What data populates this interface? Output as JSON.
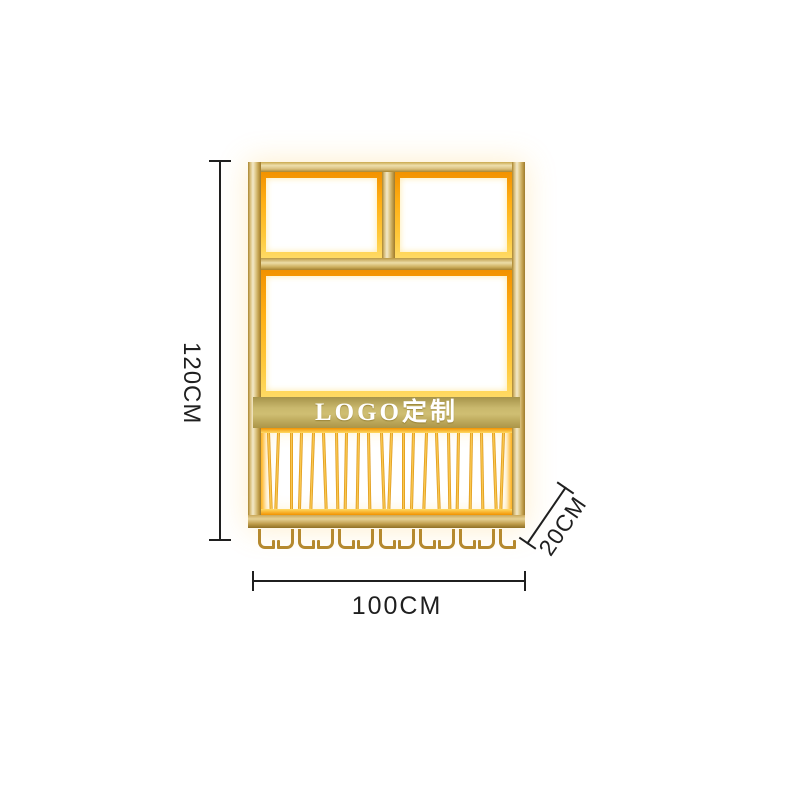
{
  "product": {
    "banner_text": "LOGO定制",
    "rail_pair_count": 11,
    "hook_count": 13
  },
  "dimensions": {
    "height_label": "120CM",
    "width_label": "100CM",
    "depth_label": "20CM"
  },
  "colors": {
    "gold_light": "#f3e9c9",
    "gold_mid": "#d9bf7d",
    "gold_dark": "#a9852f",
    "glow_deep": "#f29200",
    "glow_orange": "#ffaf14",
    "glow_bright": "#ffda64",
    "banner_gold": "#c9b86d",
    "banner_shadow": "#a6934a",
    "hook_bronze": "#b5892e",
    "dim_line": "#1f1f1f"
  }
}
